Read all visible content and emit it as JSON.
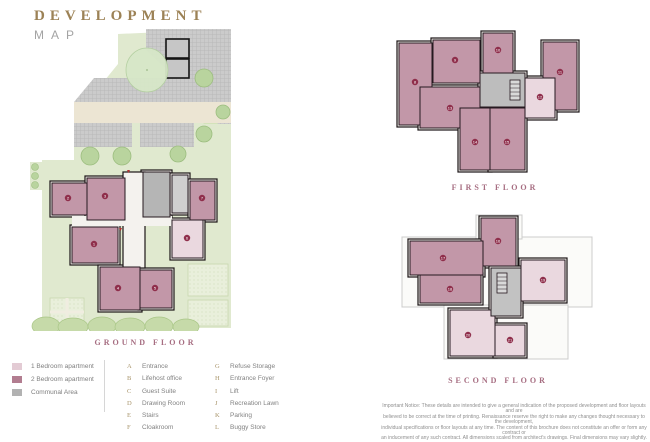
{
  "title": {
    "line1": "DEVELOPMENT",
    "line2": "MAP"
  },
  "floors": {
    "ground": "GROUND FLOOR",
    "first": "FIRST FLOOR",
    "second": "SECOND FLOOR"
  },
  "legend": {
    "swatches": [
      {
        "label": "1 Bedroom apartment",
        "color": "#e3cbd4"
      },
      {
        "label": "2 Bedroom apartment",
        "color": "#b27d90"
      },
      {
        "label": "Communal Area",
        "color": "#b2b2b2"
      }
    ],
    "keys": [
      {
        "letter": "A",
        "label": "Entrance"
      },
      {
        "letter": "B",
        "label": "Lifehost office"
      },
      {
        "letter": "C",
        "label": "Guest Suite"
      },
      {
        "letter": "D",
        "label": "Drawing Room"
      },
      {
        "letter": "E",
        "label": "Stairs"
      },
      {
        "letter": "F",
        "label": "Cloakroom"
      },
      {
        "letter": "G",
        "label": "Refuse Storage"
      },
      {
        "letter": "H",
        "label": "Entrance Foyer"
      },
      {
        "letter": "I",
        "label": "Lift"
      },
      {
        "letter": "J",
        "label": "Recreation Lawn"
      },
      {
        "letter": "K",
        "label": "Parking"
      },
      {
        "letter": "L",
        "label": "Buggy Store"
      }
    ]
  },
  "plans": {
    "ground": {
      "markers": [
        {
          "n": "2"
        },
        {
          "n": "3"
        },
        {
          "n": "7"
        },
        {
          "n": "6"
        },
        {
          "n": "1"
        },
        {
          "n": "4"
        },
        {
          "n": "5"
        }
      ]
    },
    "first": {
      "markers": [
        {
          "n": "8"
        },
        {
          "n": "9"
        },
        {
          "n": "10"
        },
        {
          "n": "11"
        },
        {
          "n": "12"
        },
        {
          "n": "13"
        },
        {
          "n": "14"
        },
        {
          "n": "15"
        }
      ]
    },
    "second": {
      "markers": [
        {
          "n": "16"
        },
        {
          "n": "17"
        },
        {
          "n": "18"
        },
        {
          "n": "19"
        },
        {
          "n": "20"
        },
        {
          "n": "21"
        }
      ]
    }
  },
  "disclaimer": {
    "line1": "Important Notice: These details are intended to give a general indication of the proposed development and floor layouts and are",
    "line2": "believed to be correct at the time of printing. Renaissance reserve the right to make any changes thought necessary to the development,",
    "line3": "individual specifications or floor layouts at any time. The content of this brochure does not constitute an offer or form any contract or",
    "line4": "an inducement of any such contract. All dimensions scaled from architect's drawings. Final dimensions may vary slightly."
  },
  "colors": {
    "accent_gold": "#9c8256",
    "floor_label_pink": "#a66d81",
    "two_bed": "#b27d90",
    "one_bed": "#e3cbd4",
    "communal": "#b2b2b2",
    "site_green": "#e0e9cf",
    "marker_maroon": "#8f2e4b"
  }
}
